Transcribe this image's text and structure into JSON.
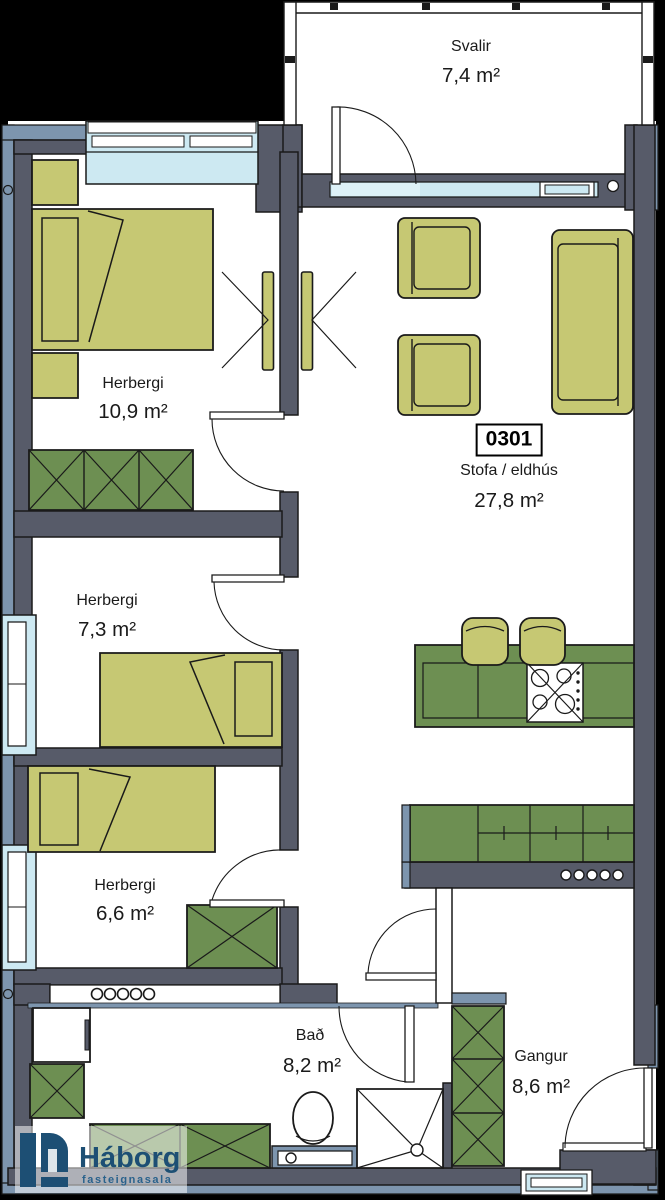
{
  "plan": {
    "unit": {
      "number": "0301"
    },
    "rooms": {
      "svalir": {
        "name": "Svalir",
        "area": "7,4 m²"
      },
      "herbergi1": {
        "name": "Herbergi",
        "area": "10,9 m²"
      },
      "stofa": {
        "name": "Stofa / eldhús",
        "area": "27,8 m²"
      },
      "herbergi2": {
        "name": "Herbergi",
        "area": "7,3 m²"
      },
      "herbergi3": {
        "name": "Herbergi",
        "area": "6,6 m²"
      },
      "bad": {
        "name": "Bað",
        "area": "8,2 m²"
      },
      "gangur": {
        "name": "Gangur",
        "area": "8,6 m²"
      }
    },
    "logo": {
      "name": "Háborg",
      "tagline": "fasteignasala"
    },
    "colors": {
      "background": "#000000",
      "wall": "#575b69",
      "lining": "#7d95ae",
      "window": "#cde9f2",
      "window_light": "#ddf1f7",
      "floor": "#ffffff",
      "furniture_light": "#c6c873",
      "furniture_dark": "#6d8f52",
      "outline": "#1a1a1a",
      "logo_navy": "#1d4f74"
    }
  }
}
